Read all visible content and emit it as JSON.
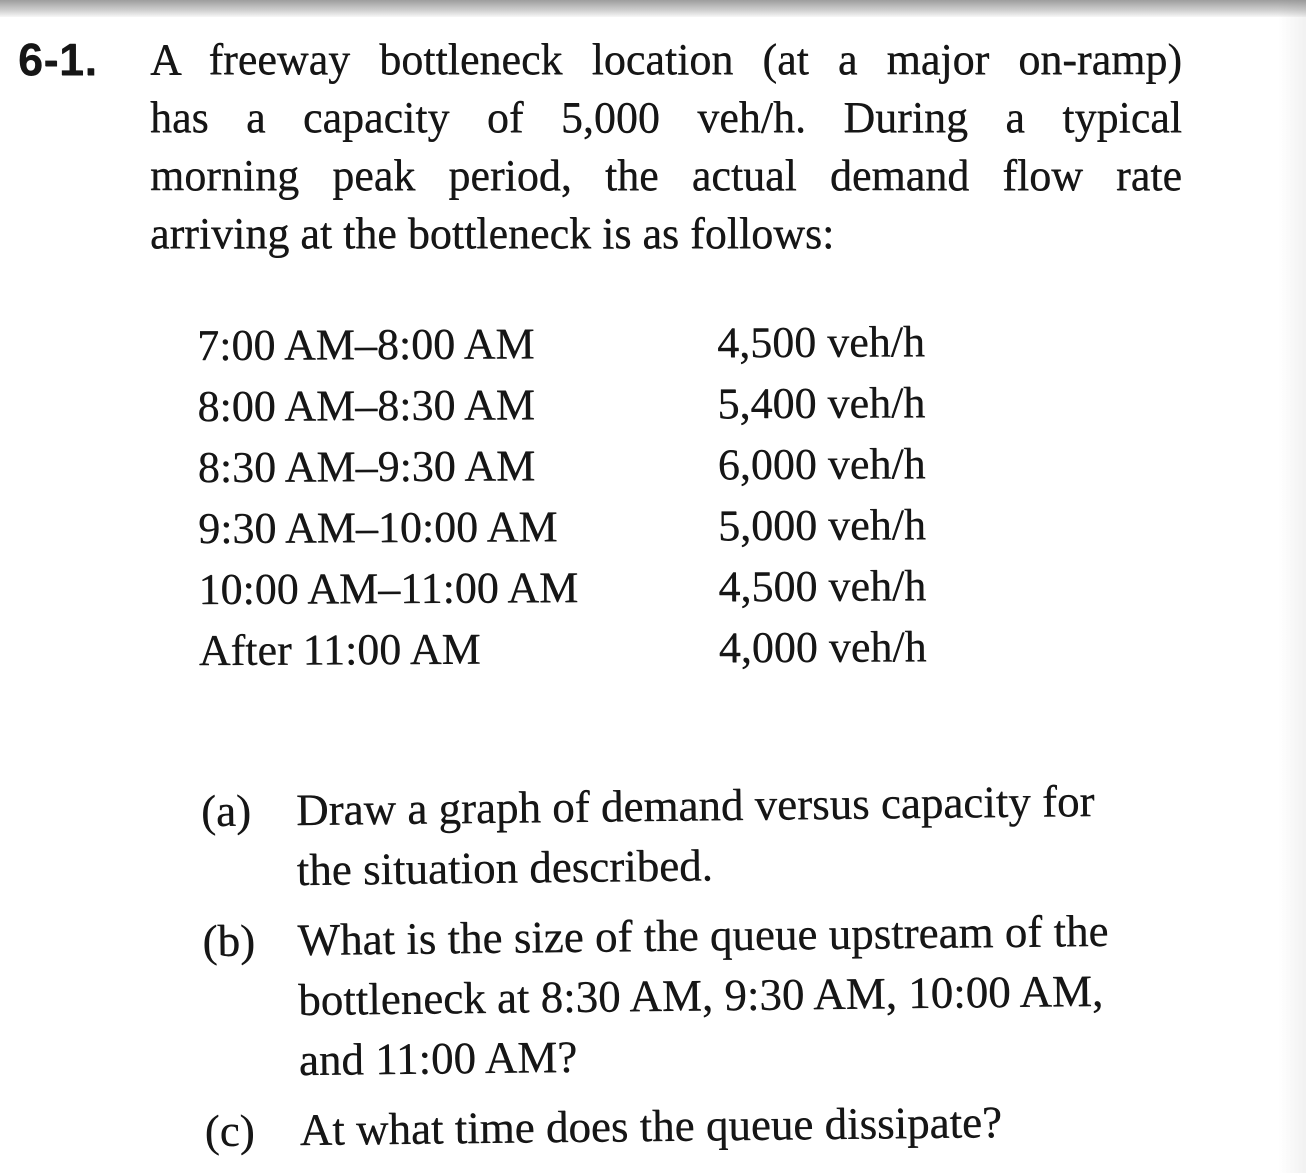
{
  "page": {
    "background": "#ffffff",
    "ink_color": "#161616",
    "scan_bar_colors": [
      "#9d9d9d",
      "#cdcdcd",
      "#f7f7f7"
    ]
  },
  "problem": {
    "number": "6-1.",
    "statement_lines": [
      "A freeway bottleneck location (at a major on-ramp)",
      "has a capacity of 5,000 veh/h. During a typical",
      "morning peak period, the actual demand flow rate",
      "arriving at the bottleneck is as follows:"
    ]
  },
  "demand_table": {
    "rows": [
      {
        "period": "7:00 AM–8:00 AM",
        "flow": "4,500 veh/h"
      },
      {
        "period": "8:00 AM–8:30 AM",
        "flow": "5,400 veh/h"
      },
      {
        "period": "8:30 AM–9:30 AM",
        "flow": "6,000 veh/h"
      },
      {
        "period": "9:30 AM–10:00 AM",
        "flow": "5,000 veh/h"
      },
      {
        "period": "10:00 AM–11:00 AM",
        "flow": "4,500 veh/h"
      },
      {
        "period": "After 11:00 AM",
        "flow": "4,000 veh/h"
      }
    ]
  },
  "questions": [
    {
      "label": "(a)",
      "lines": [
        "Draw a graph of demand versus capacity for",
        "the situation described."
      ]
    },
    {
      "label": "(b)",
      "lines": [
        "What is the size of the queue upstream of the",
        "bottleneck at 8:30 AM, 9:30 AM, 10:00 AM,",
        "and 11:00 AM?"
      ]
    },
    {
      "label": "(c)",
      "lines": [
        "At what time does the queue dissipate?"
      ]
    }
  ]
}
